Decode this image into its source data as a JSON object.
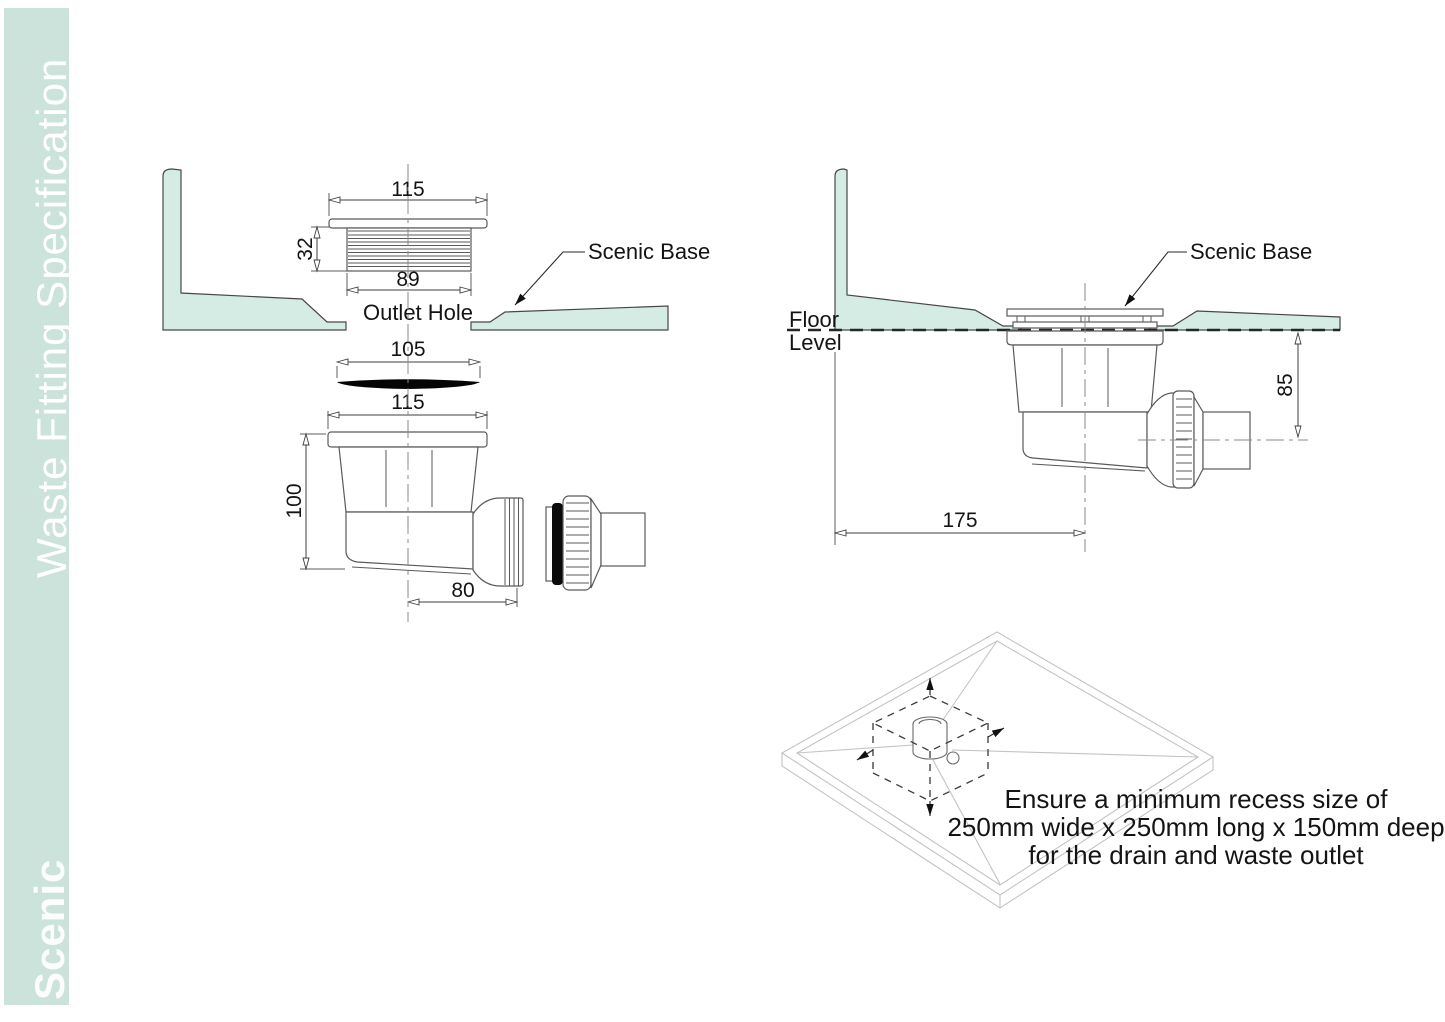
{
  "sidebar": {
    "title": "Waste Fitting Specification",
    "brand": "Scenic"
  },
  "left_drawing": {
    "dim_flange_width": "115",
    "dim_thread_height": "32",
    "dim_thread_width": "89",
    "label_outlet_hole": "Outlet Hole",
    "dim_seal_width": "105",
    "dim_trap_width": "115",
    "dim_trap_height": "100",
    "dim_outlet_offset": "80",
    "label_scenic_base": "Scenic Base"
  },
  "right_drawing": {
    "label_floor_line1": "Floor",
    "label_floor_line2": "Level",
    "label_scenic_base": "Scenic Base",
    "dim_outlet_depth": "85",
    "dim_wall_to_outlet": "175"
  },
  "isometric_note": {
    "line1": "Ensure a minimum recess size of",
    "line2": "250mm wide x 250mm long x 150mm deep",
    "line3": "for the drain and waste outlet"
  },
  "colors": {
    "sidebar_bg": "#cce3dc",
    "base_fill": "#d4ece3"
  }
}
